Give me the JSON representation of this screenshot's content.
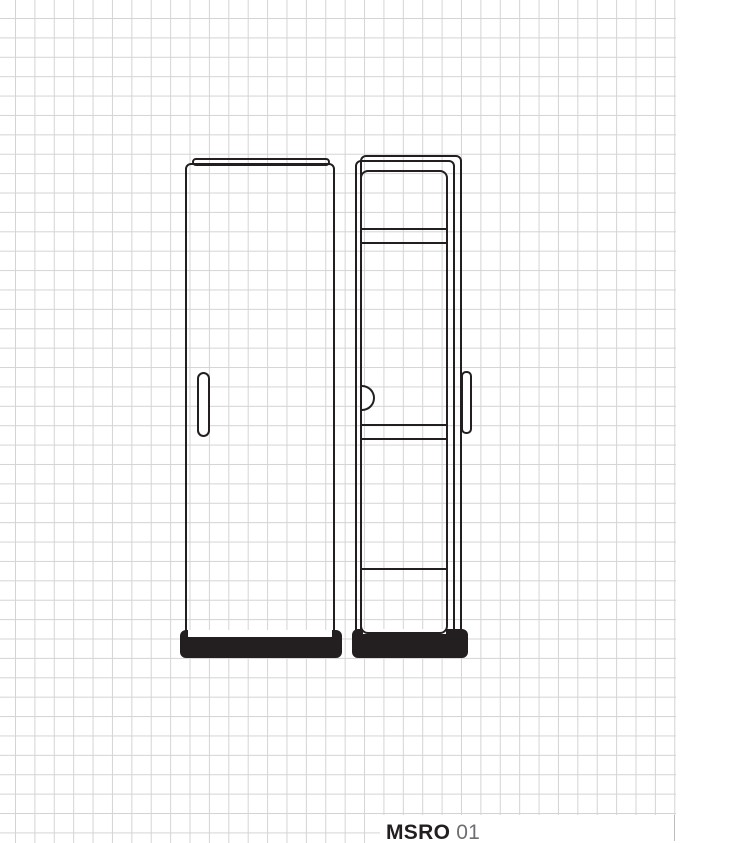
{
  "footer": {
    "model": "MSRO",
    "variant": "01"
  },
  "figure": {
    "kind": "technical-line-drawing",
    "views": {
      "front_view": "cabinet front elevation with door handle and plinth",
      "side_view": "cabinet side elevation with inner frame, three shelf edges, knob and handle profile"
    }
  },
  "colors": {
    "line": "#231f20",
    "plinth_fill": "#231f20",
    "grid_line": "#d4d4d4",
    "background": "#ffffff",
    "model_text": "#231f20",
    "variant_text": "#6d6e71"
  }
}
